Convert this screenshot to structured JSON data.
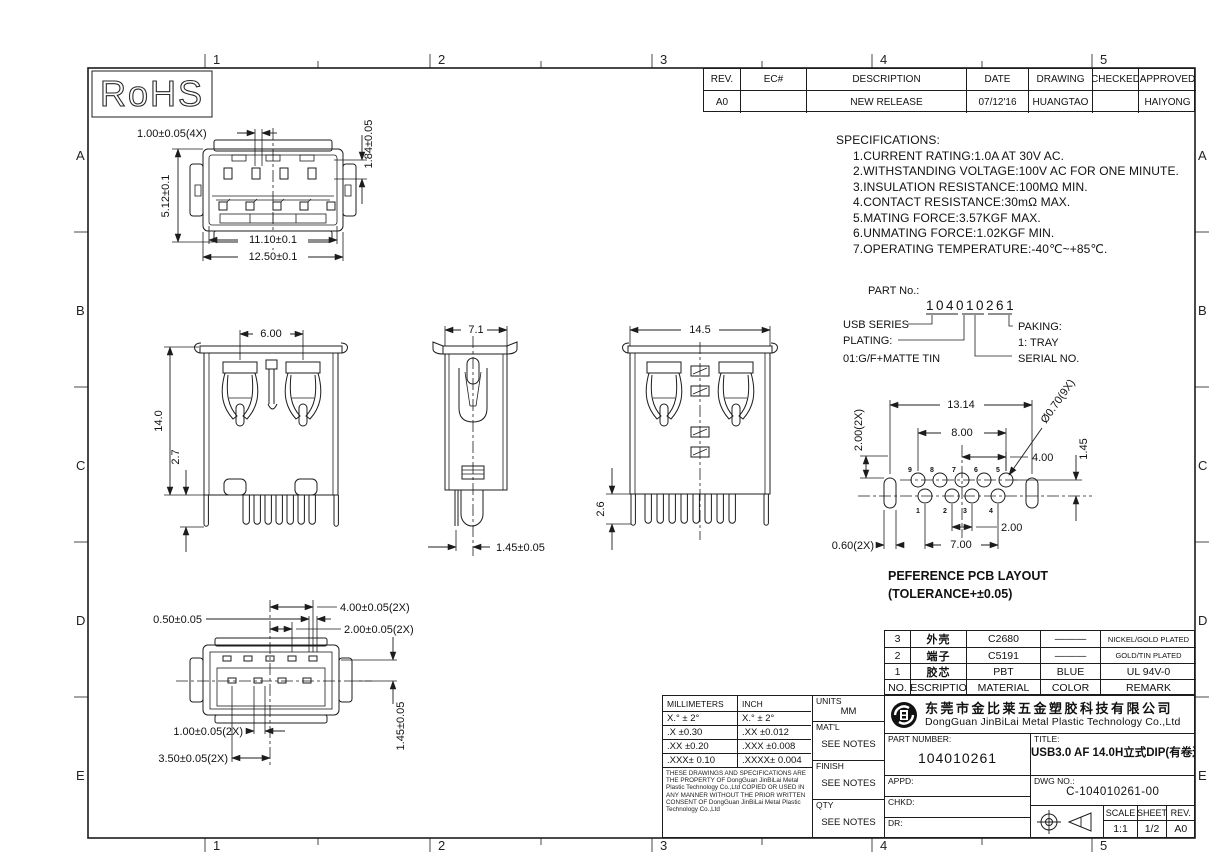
{
  "zones": {
    "cols": [
      "1",
      "2",
      "3",
      "4",
      "5"
    ],
    "rows": [
      "A",
      "B",
      "C",
      "D",
      "E"
    ]
  },
  "rohs": {
    "label": "RoHS"
  },
  "revision_table": {
    "headers": [
      "REV.",
      "EC#",
      "DESCRIPTION",
      "DATE",
      "DRAWING",
      "CHECKED",
      "APPROVED"
    ],
    "row": [
      "A0",
      "",
      "NEW RELEASE",
      "07/12'16",
      "HUANGTAO",
      "",
      "HAIYONG"
    ]
  },
  "specifications": {
    "title": "SPECIFICATIONS:",
    "items": [
      "1.CURRENT RATING:1.0A AT 30V AC.",
      "2.WITHSTANDING VOLTAGE:100V AC FOR ONE MINUTE.",
      "3.INSULATION RESISTANCE:100MΩ MIN.",
      "4.CONTACT RESISTANCE:30mΩ MAX.",
      "5.MATING FORCE:3.57KGF MAX.",
      "6.UNMATING FORCE:1.02KGF MIN.",
      "7.OPERATING TEMPERATURE:-40℃~+85℃."
    ]
  },
  "part_no": {
    "label": "PART No.:",
    "number": "104010261",
    "series_label": "USB SERIES",
    "plating_label": "PLATING:",
    "plating_value": "01:G/F+MATTE TIN",
    "paking_label": "PAKING:",
    "paking_value": "1: TRAY",
    "serial_label": "SERIAL NO."
  },
  "dims": {
    "front_pin": "1.00±0.05(4X)",
    "front_pin_h": "1.84±0.05",
    "front_shell_h": "5.12±0.1",
    "front_inner_w": "11.10±0.1",
    "front_outer_w": "12.50±0.1",
    "body_claw_pitch": "6.00",
    "body_h": "14.0",
    "body_leg": "2.7",
    "side_w": "7.1",
    "side_pin_offset": "1.45±0.05",
    "rear_w": "14.5",
    "rear_leg": "2.6",
    "pcb_slot_span": "13.14",
    "pcb_row_span": "8.00",
    "pcb_half_span": "4.00",
    "pcb_hole_dia": "Ø0.70(9X)",
    "pcb_row_gap": "1.45",
    "pcb_slot_offset": "2.00(2X)",
    "pcb_slot_w": "0.60(2X)",
    "pcb_pin_pitch": "2.00",
    "pcb_bottom_span": "7.00",
    "bottom_pad_span": "4.00±0.05(2X)",
    "bottom_pad_pitch": "2.00±0.05(2X)",
    "bottom_pad_w": "0.50±0.05",
    "bottom_pad_w2": "1.00±0.05(2X)",
    "bottom_pad_span2": "3.50±0.05(2X)",
    "bottom_row_gap": "1.45±0.05"
  },
  "pcb": {
    "pins_top": [
      "9",
      "8",
      "7",
      "6",
      "5"
    ],
    "pins_bottom": [
      "1",
      "2",
      "3",
      "4"
    ],
    "caption1": "PEFERENCE PCB LAYOUT",
    "caption2": "(TOLERANCE+±0.05)"
  },
  "material_table": {
    "rows": [
      [
        "3",
        "外壳",
        "C2680",
        "———",
        "NICKEL/GOLD PLATED"
      ],
      [
        "2",
        "端子",
        "C5191",
        "———",
        "GOLD/TIN PLATED"
      ],
      [
        "1",
        "胶芯",
        "PBT",
        "BLUE",
        "UL 94V-0"
      ]
    ],
    "footer": [
      "NO.",
      "DESCRIPTION",
      "MATERIAL",
      "COLOR",
      "REMARK"
    ]
  },
  "title_block": {
    "tol_headers": [
      "MILLIMETERS",
      "INCH"
    ],
    "tol_rows": [
      [
        "X.°  ± 2°",
        "X.°  ± 2°"
      ],
      [
        ".X  ±0.30",
        ".XX  ±0.012"
      ],
      [
        ".XX  ±0.20",
        ".XXX  ±0.008"
      ],
      [
        ".XXX± 0.10",
        ".XXXX± 0.004"
      ]
    ],
    "notice": "THESE DRAWINGS AND SPECIFICATIONS ARE THE PROPERTY OF DongGuan JinBiLai Metal Plastic Technology Co.,Ltd COPIED OR USED IN ANY MANNER WITHOUT THE PRIOR WRITTEN CONSENT OF DongGuan JinBiLai Metal Plastic Technology Co.,Ltd",
    "units_label": "UNITS",
    "units_value": "MM",
    "matl_label": "MAT'L",
    "see_notes": "SEE NOTES",
    "finish_label": "FINISH",
    "qty_label": "QTY",
    "company_cn": "东莞市金比莱五金塑胶科技有限公司",
    "company_en": "DongGuan JinBiLai Metal Plastic Technology Co.,Ltd",
    "part_number_label": "PART NUMBER:",
    "part_number": "104010261",
    "title_label": "TITLE:",
    "title": "USB3.0 AF 14.0H立式DIP(有卷边)",
    "appd_label": "APPD:",
    "chkd_label": "CHKD:",
    "dr_label": "DR:",
    "dwg_no_label": "DWG NO.:",
    "dwg_no": "C-104010261-00",
    "scale_label": "SCALE",
    "scale_value": "1:1",
    "sheet_label": "SHEET",
    "sheet_value": "1/2",
    "rev_label": "REV.",
    "rev_value": "A0"
  }
}
